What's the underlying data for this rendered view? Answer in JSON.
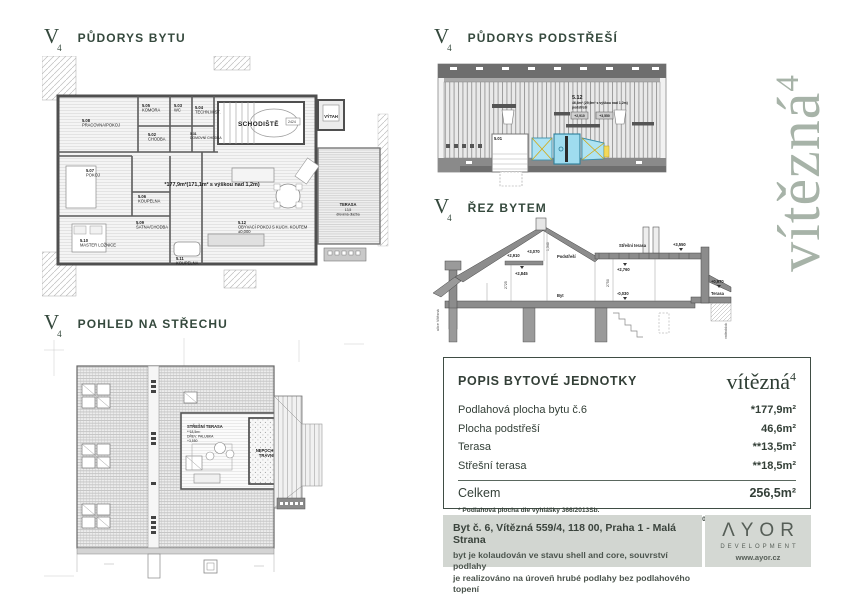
{
  "logo": {
    "letter": "V",
    "sub": "4"
  },
  "brand": {
    "name": "vítězná",
    "sup": "4"
  },
  "sections": {
    "floor_plan_title": "PŮDORYS BYTU",
    "attic_title": "PŮDORYS PODSTŘEŠÍ",
    "section_title": "ŘEZ BYTEM",
    "roof_title": "POHLED NA STŘECHU"
  },
  "floor_plan": {
    "area_note": "*177,9m²(171,1m² s výškou nad 1,2m)",
    "schodiste": "SCHODIŠTĚ",
    "stair_dim": "2424",
    "vytah": "VÝTAH",
    "terasa": "TERASA",
    "terasa_area": "13,5",
    "terasa_note": "dřevěná dlažba",
    "elev": "±0,000",
    "rooms": [
      {
        "num": "5.08",
        "name": "PRACOVNA/POKOJ"
      },
      {
        "num": "5.05",
        "name": "KOMORA"
      },
      {
        "num": "5.03",
        "name": "WC"
      },
      {
        "num": "5.04",
        "name": "TECHN.MÍST."
      },
      {
        "num": "5.02",
        "name": "CHODBA"
      },
      {
        "num": "5.31",
        "name": "DOMOVNÍ CHODBA"
      },
      {
        "num": "5.07",
        "name": "POKOJ"
      },
      {
        "num": "5.06",
        "name": "KOUPELNA"
      },
      {
        "num": "5.09",
        "name": "ŠATNA/CHODBA"
      },
      {
        "num": "5.10",
        "name": "MASTER LOŽNICE"
      },
      {
        "num": "5.11",
        "name": "KOUPELNA"
      },
      {
        "num": "5.12",
        "name": "OBÝVACÍ POKOJ S KUCH. KOUTEM"
      }
    ]
  },
  "attic": {
    "num": "5.12",
    "area": "46,6m² (29,9m² s výškou nad 1,2m)",
    "name": "podstřeší",
    "elev1": "+2,910",
    "elev2": "+3,550",
    "stair_num": "5.01"
  },
  "section_cut": {
    "e2910": "+2,910",
    "e3070": "+3,070",
    "d1340": "1,340",
    "podstresi": "Podstřeší",
    "stresni_terasa": "Střešní terasa",
    "e3550": "+3,550",
    "e2845": "+2,845",
    "e2760": "+2,760",
    "d2725": "2725",
    "d2750": "2750",
    "byt": "Byt",
    "em0030": "-0,030",
    "e0970": "+0,970",
    "terasa": "Terasa",
    "left_street": "ulice Vítězná",
    "right_block": "vnitroblok"
  },
  "roof": {
    "terrace_title": "STŘEŠNÍ TERASA",
    "terrace_area": "**18,5m²",
    "terrace_material": "DŘEV. PALUBKA",
    "terrace_elev": "+3,550",
    "lawn1": "NEPOCHOZÍ",
    "lawn2": "TRÁVNÍK"
  },
  "table": {
    "title": "POPIS BYTOVÉ JEDNOTKY",
    "rows": [
      {
        "label": "Podlahová plocha bytu č.6",
        "value": "*177,9m²"
      },
      {
        "label": "Plocha podstřeší",
        "value": "46,6m²"
      },
      {
        "label": "Terasa",
        "value": "**13,5m²"
      },
      {
        "label": "Střešní terasa",
        "value": "**18,5m²"
      }
    ],
    "total_label": "Celkem",
    "total_value": "256,5m²",
    "footnote1": "* Podlahová plocha dle vyhlášky 366/2013Sb.",
    "footnote2": "** Venkovní terasa je ve výhradním užívání bytu č.6",
    "note_right": "pozn.: ±0,000 je úroveň stávajícího bytu"
  },
  "footer": {
    "address": "Byt č. 6, Vítězná 559/4, 118 00, Praha 1 - Malá Strana",
    "line1": "byt je kolaudován ve stavu shell and core, souvrství podlahy",
    "line2": "je realizováno na úroveň hrubé podlahy bez podlahového topení",
    "logo": "ΛYOR",
    "logo_sub": "DEVELOPMENT",
    "website": "www.ayor.cz"
  },
  "colors": {
    "accent_green": "#35493d",
    "brand_sage": "#a7b3a8",
    "footer_gray": "#d2d6d1",
    "hvac_cyan": "#9fdcef"
  }
}
